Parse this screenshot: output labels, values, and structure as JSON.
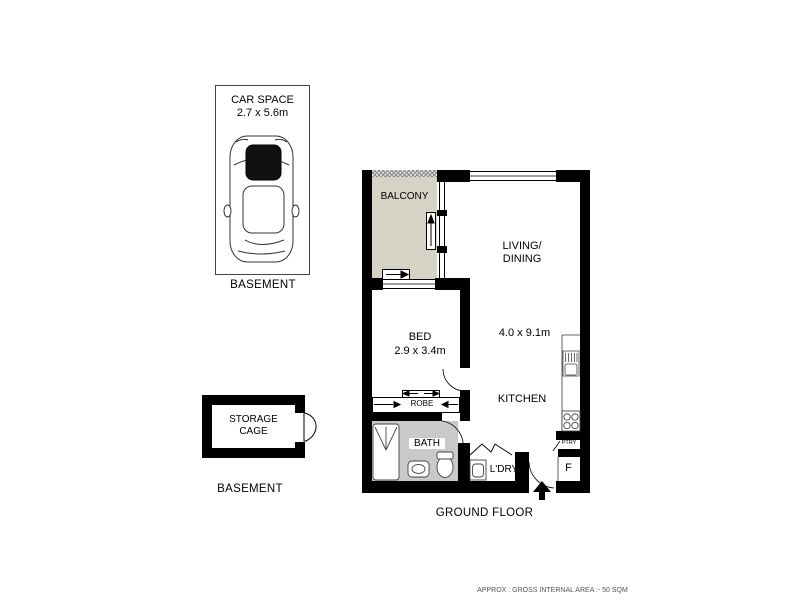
{
  "page": {
    "footer_note": "APPROX : GROSS INTERNAL AREA :- 50 SQM"
  },
  "basement_car": {
    "title": "CAR SPACE",
    "dims": "2.7 x 5.6m",
    "floor_caption": "BASEMENT"
  },
  "basement_storage": {
    "line1": "STORAGE",
    "line2": "CAGE",
    "floor_caption": "BASEMENT"
  },
  "apartment": {
    "floor_caption": "GROUND FLOOR",
    "balcony": "BALCONY",
    "living_line1": "LIVING/",
    "living_line2": "DINING",
    "living_dims": "4.0 x 9.1m",
    "bed": "BED",
    "bed_dims": "2.9 x 3.4m",
    "robe": "ROBE",
    "kitchen": "KITCHEN",
    "bath": "BATH",
    "laundry": "L'DRY",
    "pantry": "PTRY",
    "fridge": "F"
  },
  "colors": {
    "wall": "#000000",
    "balcony_fill": "#d6d2c5",
    "bath_fill": "#c9c9c9",
    "footer_text": "#555555"
  }
}
